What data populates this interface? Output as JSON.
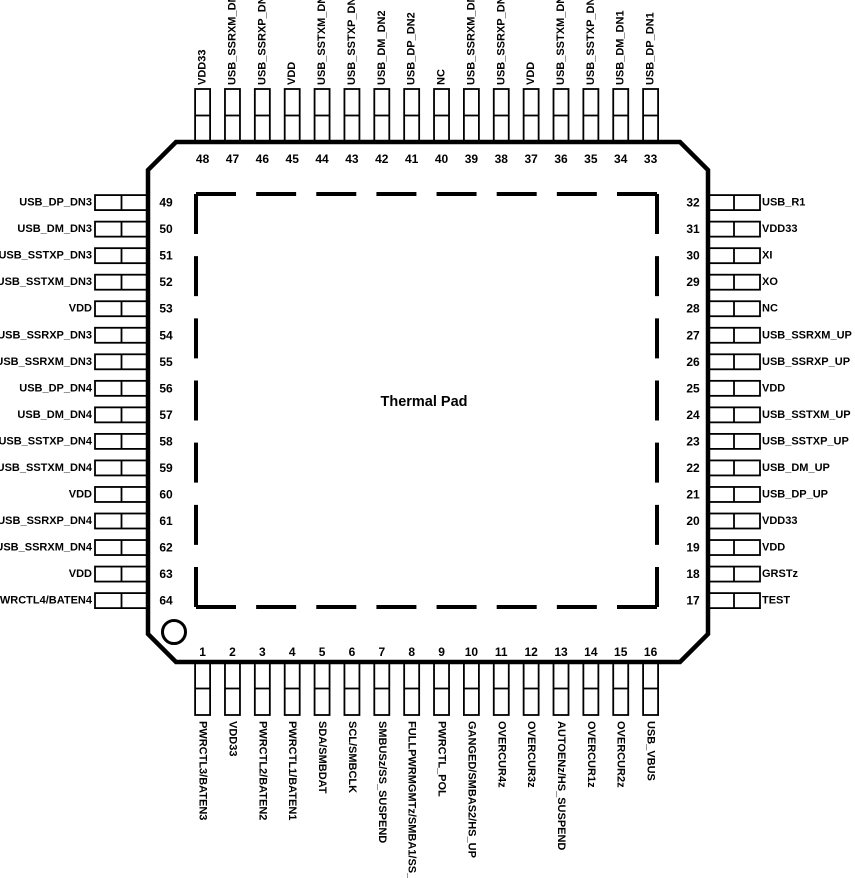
{
  "center_label": "Thermal Pad",
  "colors": {
    "ink": "#000000",
    "background": "#ffffff"
  },
  "package": {
    "top_pins": [
      {
        "number": 48,
        "label": "VDD33"
      },
      {
        "number": 47,
        "label": "USB_SSRXM_DN2"
      },
      {
        "number": 46,
        "label": "USB_SSRXP_DN2"
      },
      {
        "number": 45,
        "label": "VDD"
      },
      {
        "number": 44,
        "label": "USB_SSTXM_DN2"
      },
      {
        "number": 43,
        "label": "USB_SSTXP_DN2"
      },
      {
        "number": 42,
        "label": "USB_DM_DN2"
      },
      {
        "number": 41,
        "label": "USB_DP_DN2"
      },
      {
        "number": 40,
        "label": "NC"
      },
      {
        "number": 39,
        "label": "USB_SSRXM_DN1"
      },
      {
        "number": 38,
        "label": "USB_SSRXP_DN1"
      },
      {
        "number": 37,
        "label": "VDD"
      },
      {
        "number": 36,
        "label": "USB_SSTXM_DN1"
      },
      {
        "number": 35,
        "label": "USB_SSTXP_DN1"
      },
      {
        "number": 34,
        "label": "USB_DM_DN1"
      },
      {
        "number": 33,
        "label": "USB_DP_DN1"
      }
    ],
    "left_pins": [
      {
        "number": 49,
        "label": "USB_DP_DN3"
      },
      {
        "number": 50,
        "label": "USB_DM_DN3"
      },
      {
        "number": 51,
        "label": "USB_SSTXP_DN3"
      },
      {
        "number": 52,
        "label": "USB_SSTXM_DN3"
      },
      {
        "number": 53,
        "label": "VDD"
      },
      {
        "number": 54,
        "label": "USB_SSRXP_DN3"
      },
      {
        "number": 55,
        "label": "USB_SSRXM_DN3"
      },
      {
        "number": 56,
        "label": "USB_DP_DN4"
      },
      {
        "number": 57,
        "label": "USB_DM_DN4"
      },
      {
        "number": 58,
        "label": "USB_SSTXP_DN4"
      },
      {
        "number": 59,
        "label": "USB_SSTXM_DN4"
      },
      {
        "number": 60,
        "label": "VDD"
      },
      {
        "number": 61,
        "label": "USB_SSRXP_DN4"
      },
      {
        "number": 62,
        "label": "USB_SSRXM_DN4"
      },
      {
        "number": 63,
        "label": "VDD"
      },
      {
        "number": 64,
        "label": "PWRCTL4/BATEN4"
      }
    ],
    "right_pins": [
      {
        "number": 32,
        "label": "USB_R1"
      },
      {
        "number": 31,
        "label": "VDD33"
      },
      {
        "number": 30,
        "label": "XI"
      },
      {
        "number": 29,
        "label": "XO"
      },
      {
        "number": 28,
        "label": "NC"
      },
      {
        "number": 27,
        "label": "USB_SSRXM_UP"
      },
      {
        "number": 26,
        "label": "USB_SSRXP_UP"
      },
      {
        "number": 25,
        "label": "VDD"
      },
      {
        "number": 24,
        "label": "USB_SSTXM_UP"
      },
      {
        "number": 23,
        "label": "USB_SSTXP_UP"
      },
      {
        "number": 22,
        "label": "USB_DM_UP"
      },
      {
        "number": 21,
        "label": "USB_DP_UP"
      },
      {
        "number": 20,
        "label": "VDD33"
      },
      {
        "number": 19,
        "label": "VDD"
      },
      {
        "number": 18,
        "label": "GRSTz"
      },
      {
        "number": 17,
        "label": "TEST"
      }
    ],
    "bottom_pins": [
      {
        "number": 1,
        "label": "PWRCTL3/BATEN3"
      },
      {
        "number": 2,
        "label": "VDD33"
      },
      {
        "number": 3,
        "label": "PWRCTL2/BATEN2"
      },
      {
        "number": 4,
        "label": "PWRCTL1/BATEN1"
      },
      {
        "number": 5,
        "label": "SDA/SMBDAT"
      },
      {
        "number": 6,
        "label": "SCL/SMBCLK"
      },
      {
        "number": 7,
        "label": "SMBUSz/SS_SUSPEND"
      },
      {
        "number": 8,
        "label": "FULLPWRMGMTz/SMBA1/SS_UP"
      },
      {
        "number": 9,
        "label": "PWRCTL_POL"
      },
      {
        "number": 10,
        "label": "GANGED/SMBAS2/HS_UP"
      },
      {
        "number": 11,
        "label": "OVERCUR4z"
      },
      {
        "number": 12,
        "label": "OVERCUR3z"
      },
      {
        "number": 13,
        "label": "AUTOENz/HS_SUSPEND"
      },
      {
        "number": 14,
        "label": "OVERCUR1z"
      },
      {
        "number": 15,
        "label": "OVERCUR2z"
      },
      {
        "number": 16,
        "label": "USB_VBUS"
      }
    ]
  }
}
